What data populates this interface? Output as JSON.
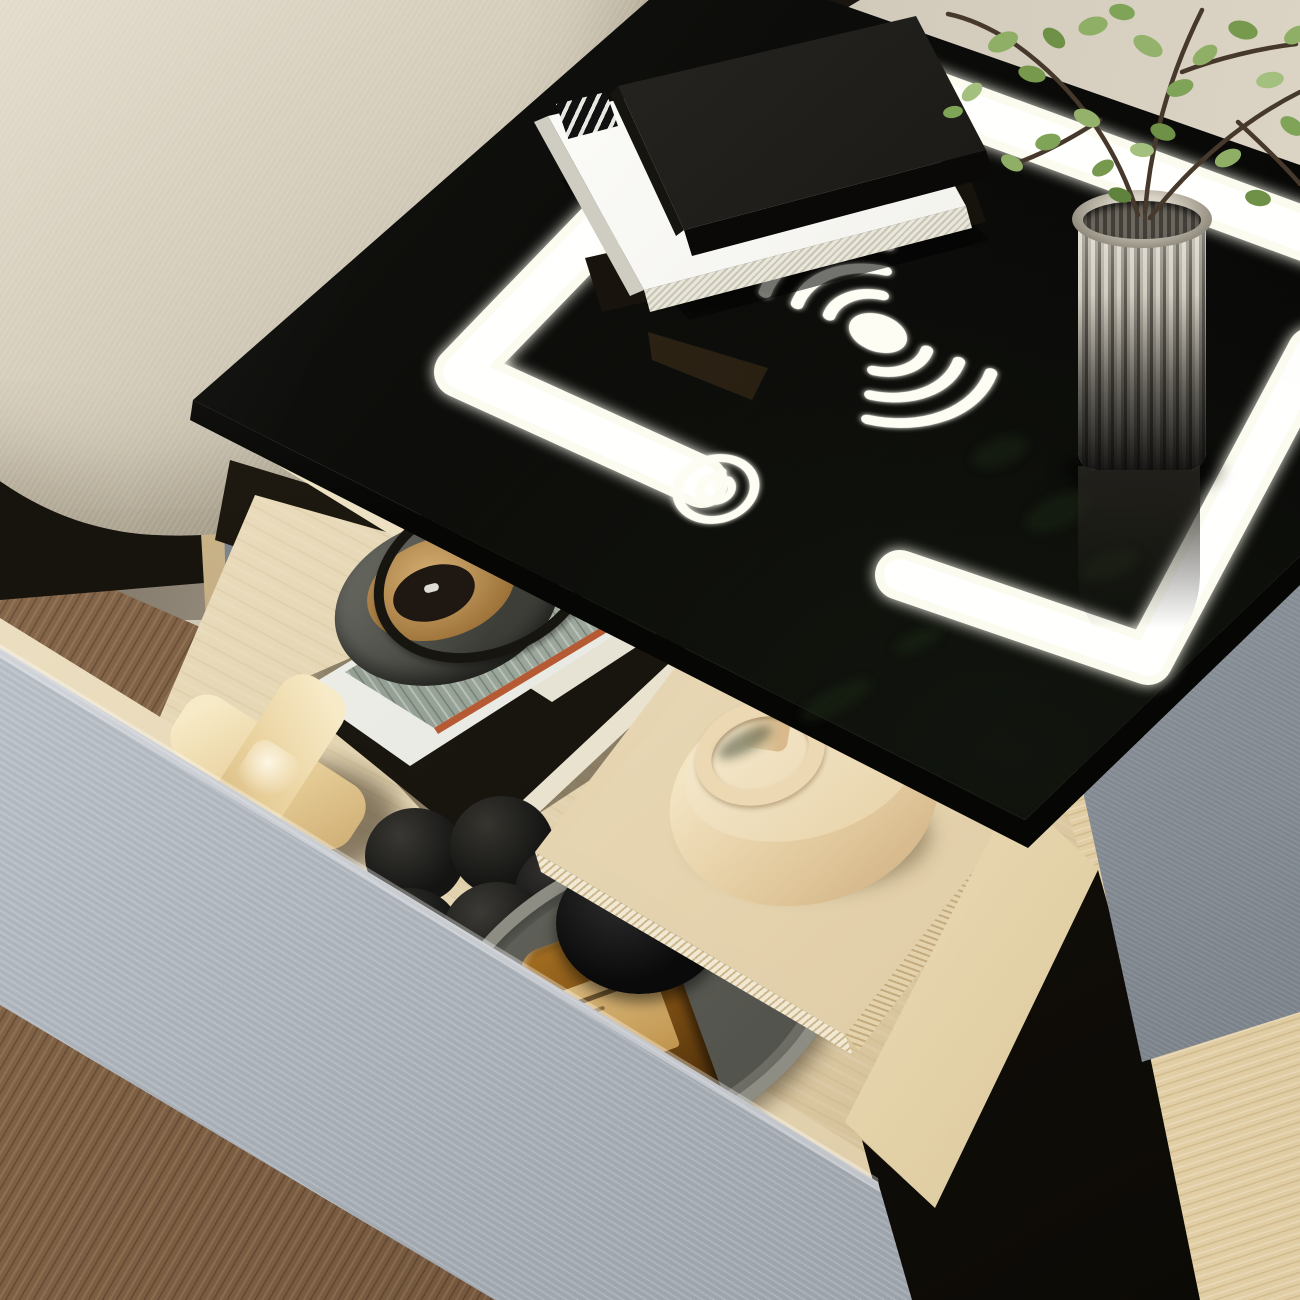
{
  "scene": {
    "title": "Smart LED nightstand with wireless charging glass top and open storage drawer",
    "type": "product-photo",
    "environment": {
      "wall": {
        "description": "beige wall with taupe wood-grain panel section",
        "color_left": "#847a6b",
        "color_right": "#d9d2c2"
      },
      "sofa": {
        "description": "beige fabric sofa cushion corner, top-left",
        "color": "#d9d2c3"
      },
      "floor_left": {
        "description": "dark walnut plank floor, bottom-left",
        "color": "#7c5f45"
      },
      "floor_right": {
        "description": "light oak plank floor, bottom-right",
        "color": "#ddc89e"
      }
    },
    "furniture": {
      "tabletop": {
        "description": "black glossy tempered glass top",
        "color": "#0d0d0b"
      },
      "led_frame": {
        "description": "glowing white LED square frame embedded in glass, corner brackets and side strip",
        "color": "#fbfbf2"
      },
      "body_side_panel": {
        "description": "gray upholstered cabinet side panel",
        "color": "#949aa2"
      },
      "drawer_box": {
        "description": "open light-maple wood drawer",
        "color": "#e8dcc0"
      },
      "drawer_front": {
        "description": "light blue-gray textured fabric drawer front",
        "color": "#b9bfc7"
      },
      "leg": {
        "description": "gray metal leg under sofa-side corner",
        "color": "#848b93"
      }
    },
    "icons": [
      {
        "name": "wireless-charging-icon",
        "description": "glowing center dot with three signal arcs on each side",
        "color": "#fdfdf3"
      },
      {
        "name": "power-icon",
        "description": "glowing power button ring with power glyph",
        "color": "#fdfdf3"
      }
    ],
    "objects_on_top": [
      {
        "name": "black-book",
        "description": "black hardcover book on top of stack",
        "color": "#1b1a17"
      },
      {
        "name": "white-book",
        "description": "white book with small black label under black book",
        "color": "#f3f2ee"
      },
      {
        "name": "dark-folio",
        "description": "dark folio beneath book stack",
        "color": "#141109"
      },
      {
        "name": "glass-vase",
        "description": "ribbed glass cylinder vase",
        "color": "#b9b3a6"
      },
      {
        "name": "plant-branches",
        "description": "green leafy branches in vase",
        "leaf_color": "#8fae66",
        "branch_color": "#46382a"
      }
    ],
    "drawer_items": [
      {
        "name": "magazine-stack",
        "description": "black folio and white magazine with gray-green marble cover",
        "colors": [
          "#17140e",
          "#edefe9",
          "#8a968c"
        ]
      },
      {
        "name": "round-candle-dish",
        "description": "dark gray round dish with tan interior and black ring handle",
        "colors": [
          "#55564e",
          "#caa06a",
          "#17150f"
        ]
      },
      {
        "name": "cross-sculpture",
        "description": "cream ceramic plus/cross shaped object",
        "color": "#ecd9b0"
      },
      {
        "name": "grape-sculpture",
        "description": "matte black grape-cluster ball sculpture",
        "color": "#161616"
      },
      {
        "name": "oval-tray",
        "description": "warm gray oval tray with raised rim",
        "color": "#6e6e67"
      },
      {
        "name": "perfume-bottle",
        "description": "amber glass bottle with tan label and black dome cap",
        "colors": [
          "#8a5718",
          "#cda265",
          "#0b0b0b"
        ]
      },
      {
        "name": "beige-book-stack",
        "description": "two stacked beige hardcover books",
        "colors": [
          "#e7d6b4",
          "#e2d0ac"
        ]
      },
      {
        "name": "candle-holder-vase",
        "description": "cream ceramic candle holder with spout and loop handle",
        "color": "#ecdcba"
      }
    ],
    "lighting": {
      "description": "LED frame and icons emit warm-white glow reflected on glass and drawer edge",
      "glow_color": "#fffef0"
    }
  }
}
